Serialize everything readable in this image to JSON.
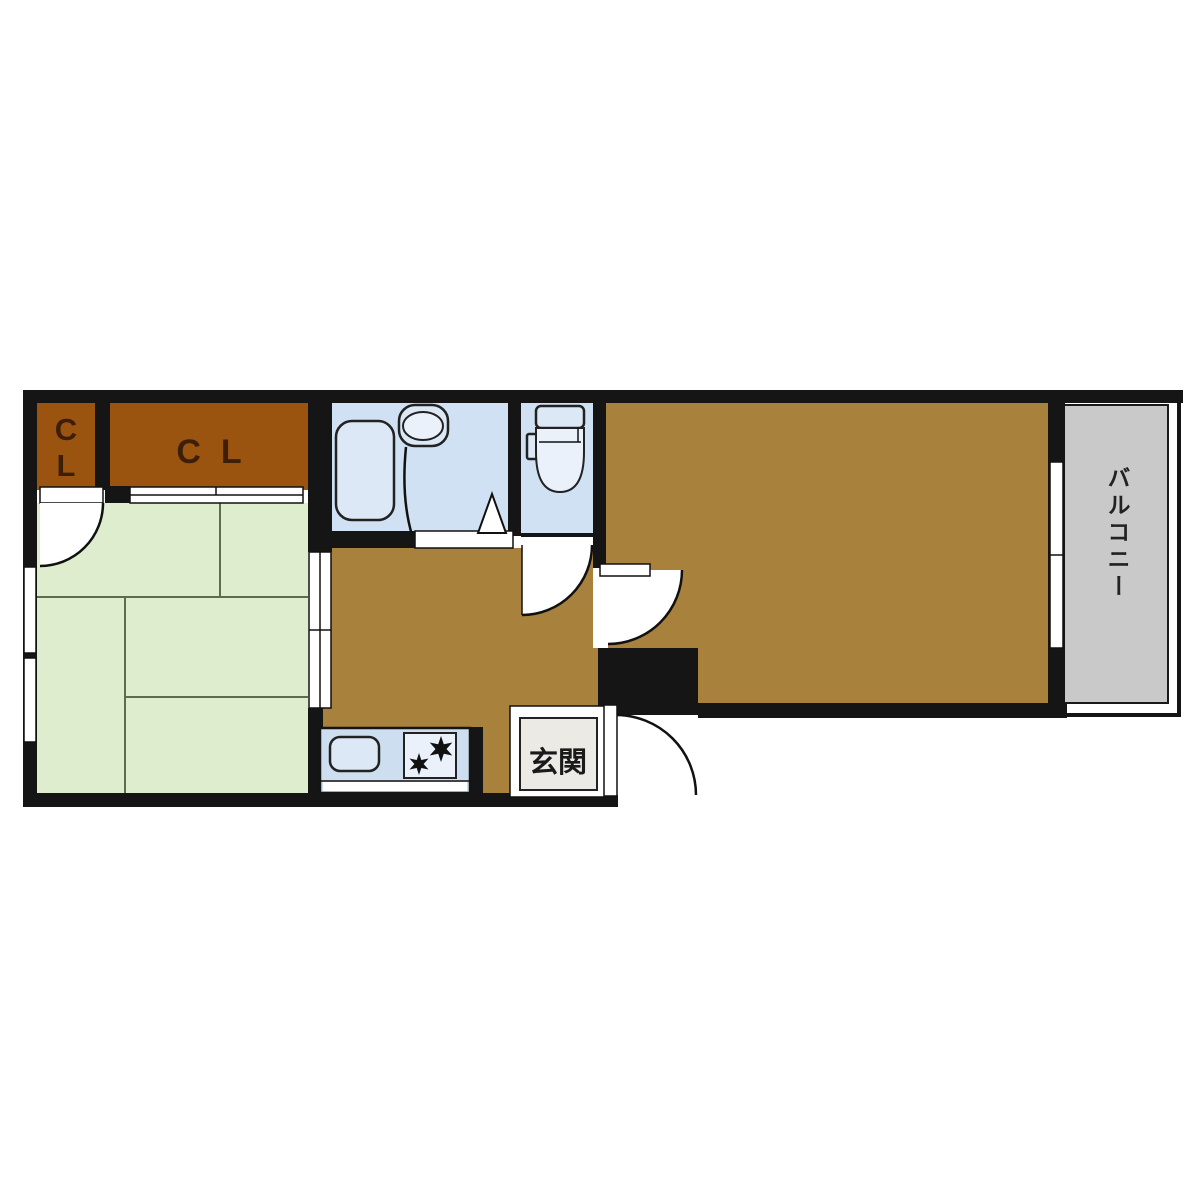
{
  "floorplan": {
    "labels": {
      "closet_1": "CL",
      "closet_2": "CL",
      "entrance": "玄関",
      "balcony": "バルコニー"
    },
    "colors": {
      "wall": "#151515",
      "closet_floor": "#9b5310",
      "wood_floor": "#a8813d",
      "tatami_floor": "#deedcd",
      "bathroom_floor": "#cfe1f2",
      "toilet_floor": "#cfe1f2",
      "counter_fill": "#ccdeef",
      "fixture_fill": "#dce8f6",
      "balcony_floor": "#c9c9c9",
      "entrance_floor": "#eceae5"
    }
  }
}
